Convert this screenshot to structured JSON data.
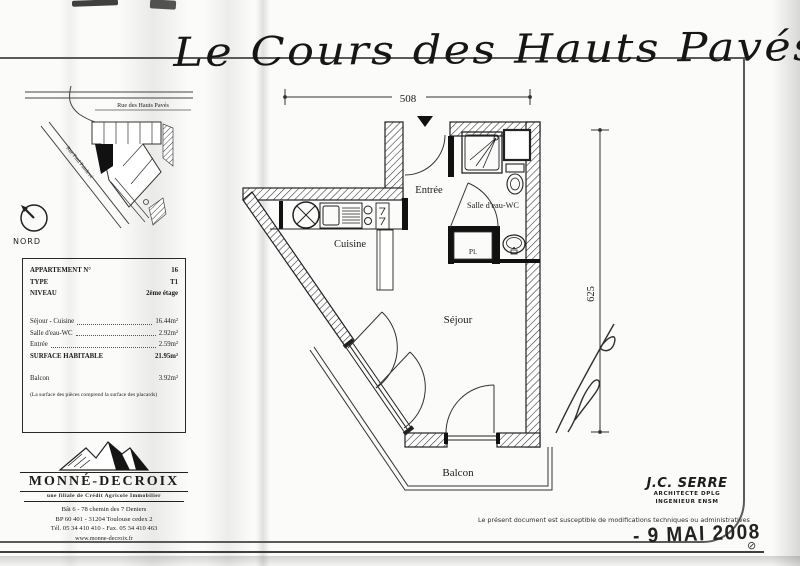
{
  "title": "Le Cours des Hauts Pavés",
  "map": {
    "street_top": "Rue des Hauts Pavés",
    "street_side": "Rue Paul Painlevé",
    "compass": "NORD"
  },
  "info": {
    "header_rows": [
      {
        "label": "APPARTEMENT N°",
        "value": "16"
      },
      {
        "label": "TYPE",
        "value": "T1"
      },
      {
        "label": "NIVEAU",
        "value": "2ème étage"
      }
    ],
    "area_rows": [
      {
        "label": "Séjour - Cuisine",
        "value": "16.44m²"
      },
      {
        "label": "Salle d'eau-WC",
        "value": "2.92m²"
      },
      {
        "label": "Entrée",
        "value": "2.59m²"
      }
    ],
    "total_label": "SURFACE HABITABLE",
    "total_value": "21.95m²",
    "balcony_label": "Balcon",
    "balcony_value": "3.92m²",
    "note": "(La surface des pièces comprend la surface des placards)"
  },
  "brand": {
    "name": "MONNÉ-DECROIX",
    "subtitle": "une filiale de Crédit Agricole Immobilier",
    "address_line1": "Bât 6 - 78 chemin des 7 Deniers",
    "address_line2": "BP 60 401 - 31204 Toulouse cedex 2",
    "address_line3": "Tél. 05 34 410 410 - Fax. 05 34 410 463",
    "website": "www.monne-decroix.fr"
  },
  "plan": {
    "dim_width": "508",
    "dim_height": "625",
    "labels": {
      "entree": "Entrée",
      "bathroom": "Salle d'eau-WC",
      "kitchen": "Cuisine",
      "living": "Séjour",
      "balcony": "Balcon",
      "closet": "Pl."
    }
  },
  "architect": {
    "name": "J.C. SERRE",
    "title1": "ARCHITECTE DPLG",
    "title2": "INGENIEUR ENSM"
  },
  "disclaimer": "Le présent document est susceptible de modifications techniques ou administratives",
  "stamp": "- 9 MAI 2008"
}
